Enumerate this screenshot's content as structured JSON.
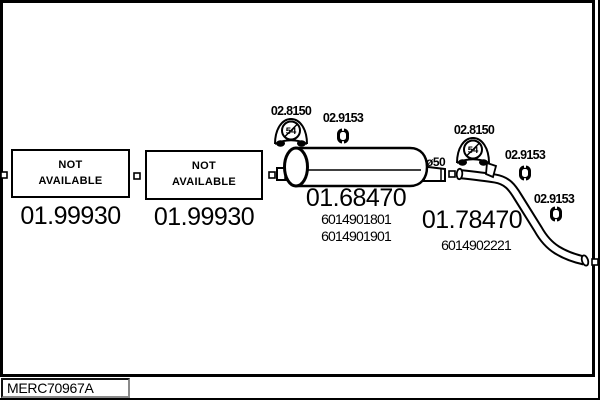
{
  "palette": {
    "ink": "#000000",
    "paper": "#ffffff",
    "shadow": "#8a8a8a"
  },
  "footer": {
    "drawing_code": "MERC70967A"
  },
  "unavailable_parts": [
    {
      "status_line1": "NOT",
      "status_line2": "AVAILABLE",
      "part_number": "01.99930"
    },
    {
      "status_line1": "NOT",
      "status_line2": "AVAILABLE",
      "part_number": "01.99930"
    }
  ],
  "muffler": {
    "part_number": "01.68470",
    "oem_numbers": [
      "6014901801",
      "6014901901"
    ],
    "pipe_diameter": "ø50"
  },
  "tailpipe": {
    "part_number": "01.78470",
    "oem_numbers": [
      "6014902221"
    ]
  },
  "accessories": {
    "bracket_part_number": "02.8150",
    "bracket_badge": "54",
    "hanger_part_number": "02.9153"
  }
}
